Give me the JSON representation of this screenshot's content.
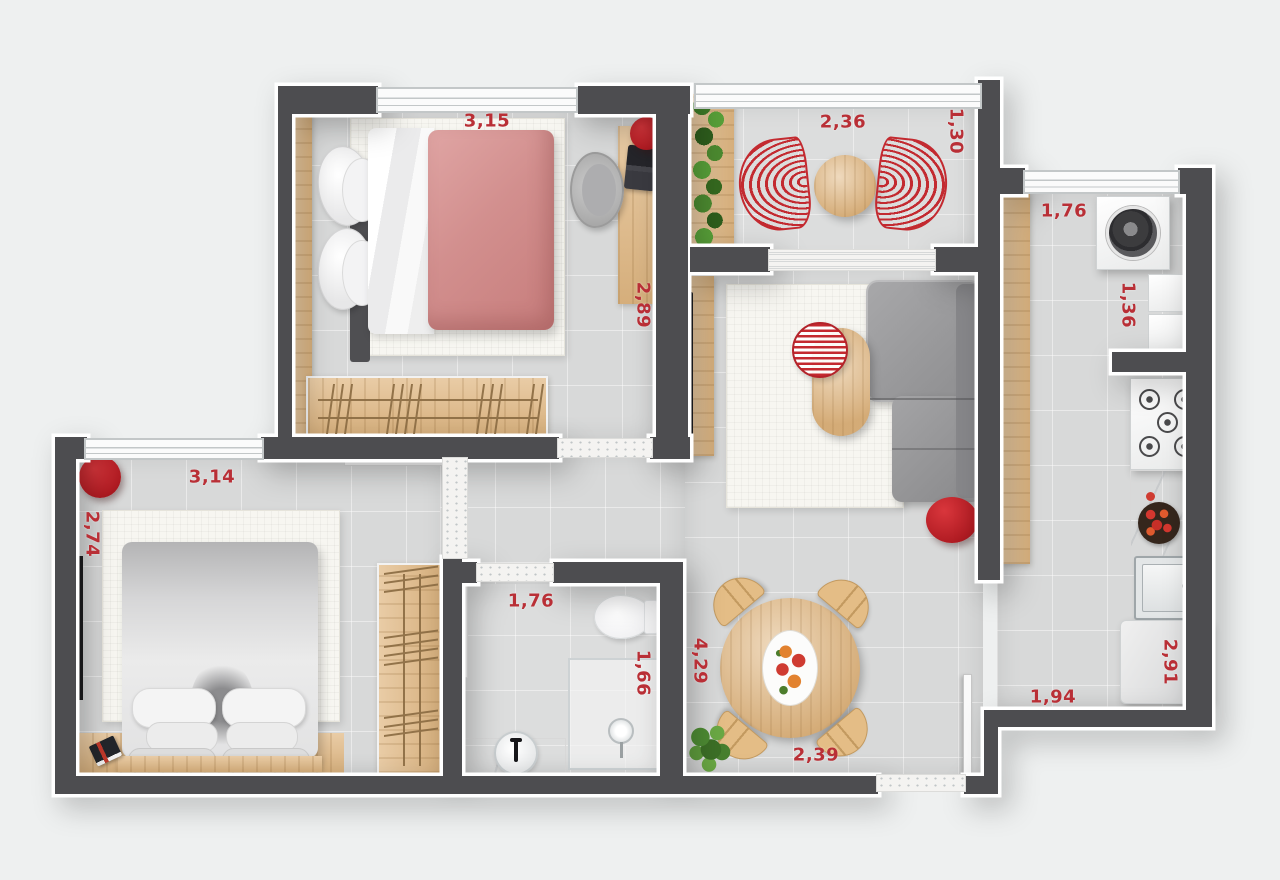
{
  "plan": {
    "type": "apartment-floor-plan",
    "accent_color": "#b92f36",
    "wall_color": "#4d4d50",
    "wood_color": "#e2bb88",
    "rooms": {
      "bedroom1": {
        "width": "3,15",
        "depth": "2,89"
      },
      "balcony": {
        "width": "2,36",
        "depth": "1,30"
      },
      "laundry": {
        "width": "1,76",
        "depth": "1,36"
      },
      "kitchen": {
        "depth": "2,91",
        "width": "1,94"
      },
      "living_dining": {
        "depth": "4,29",
        "width": "2,39"
      },
      "bedroom2": {
        "width": "3,14",
        "depth": "2,74"
      },
      "bathroom": {
        "width": "1,76",
        "depth": "1,66"
      }
    }
  }
}
